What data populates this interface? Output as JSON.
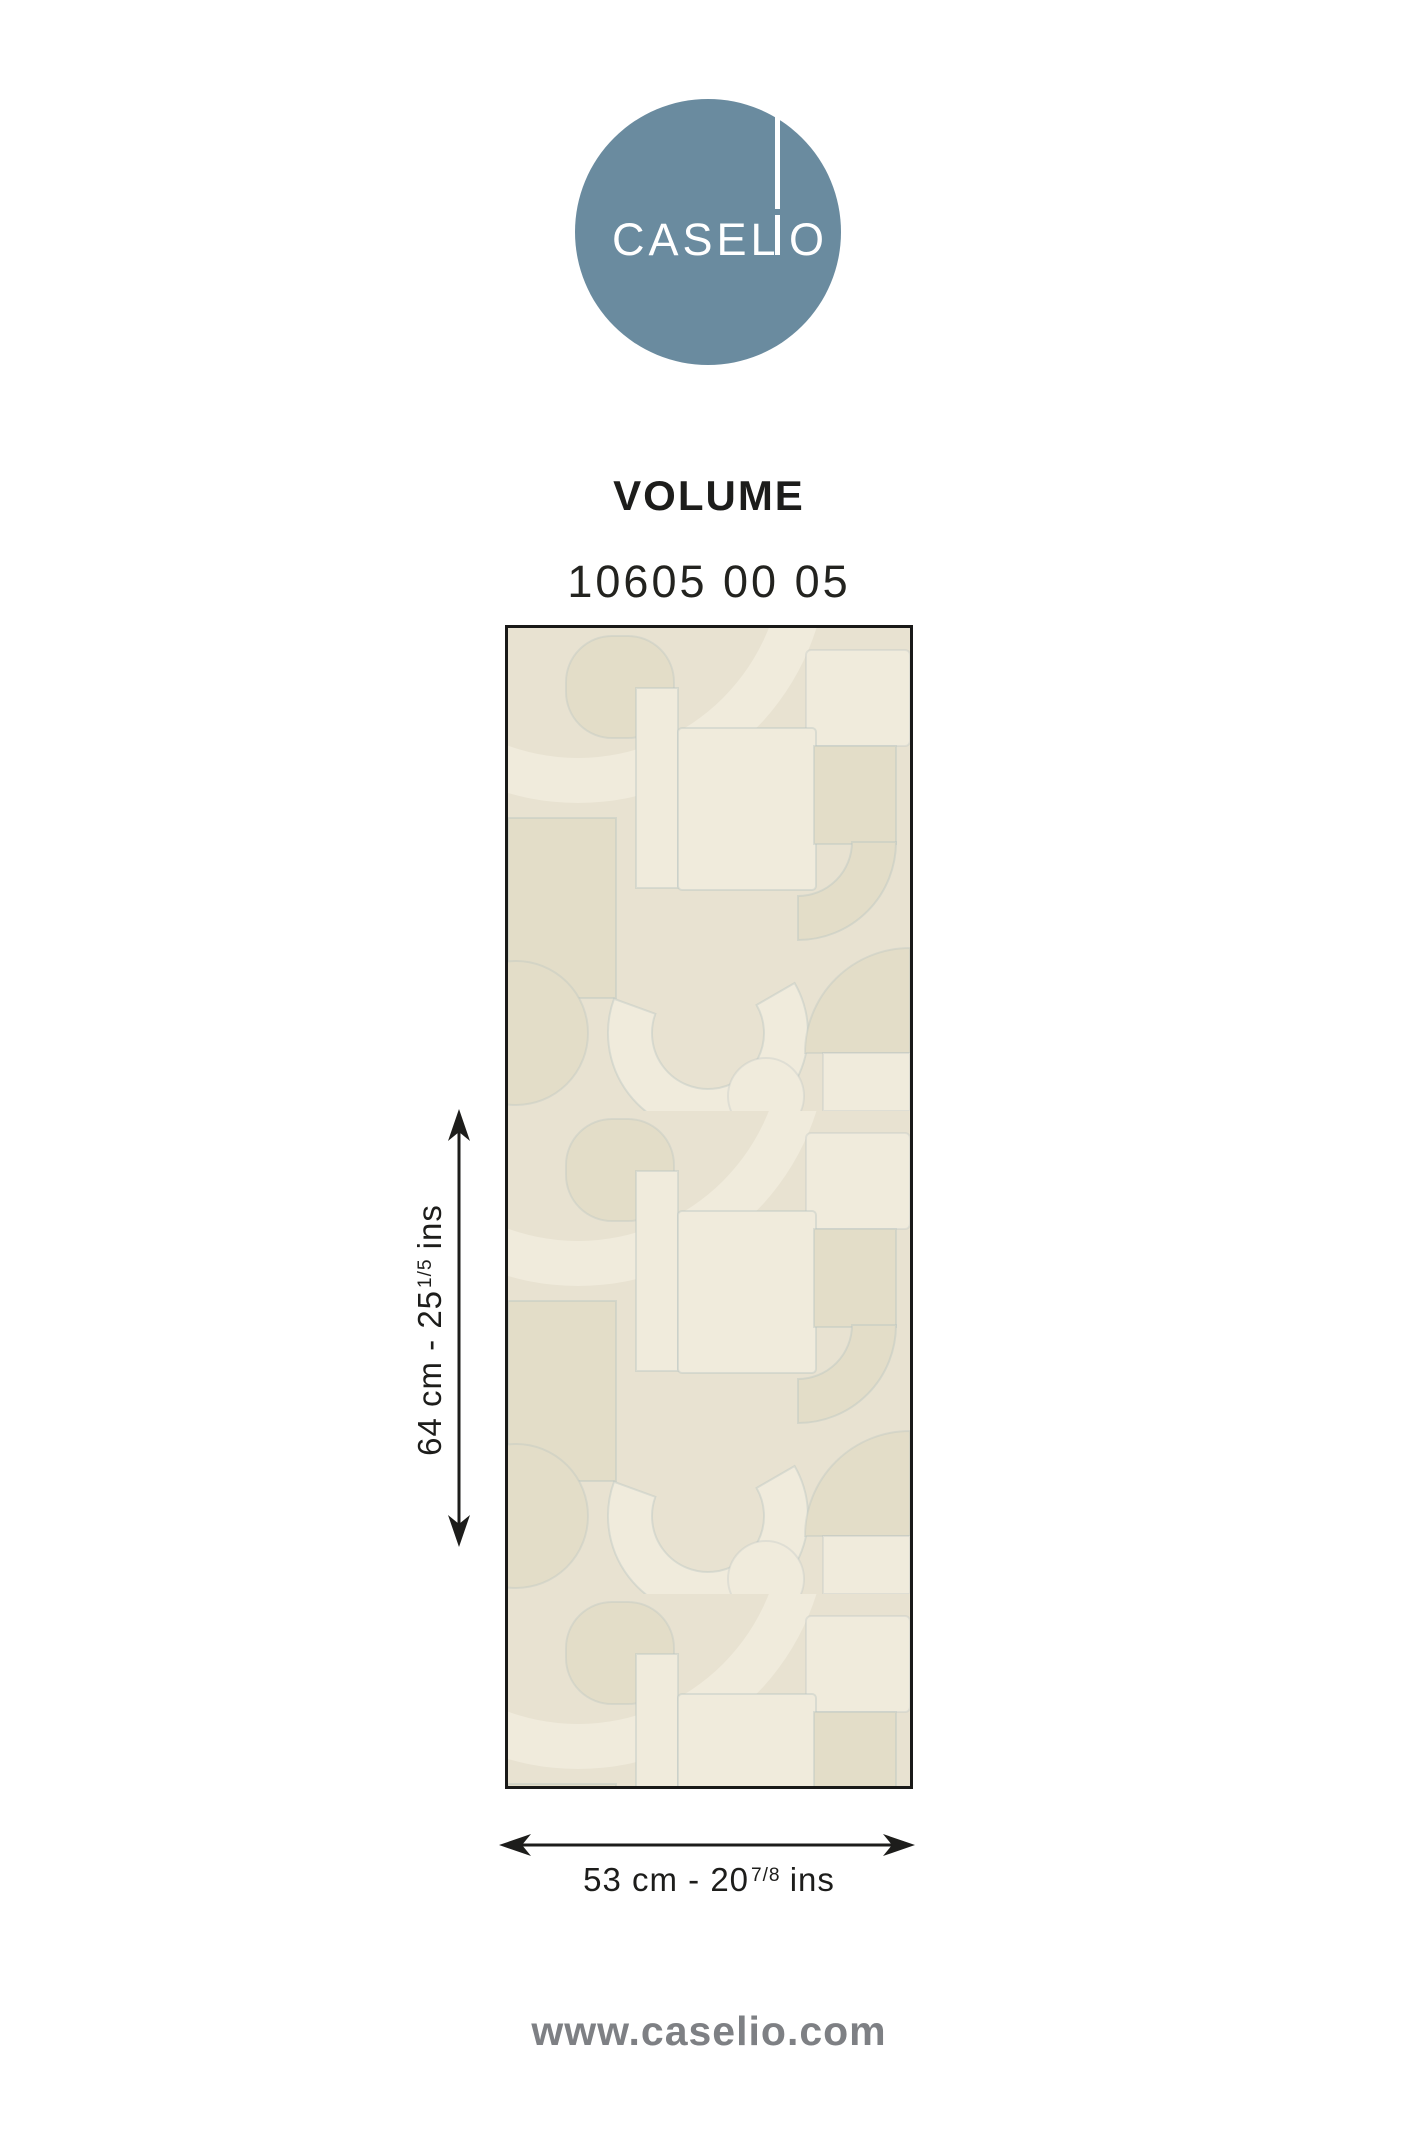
{
  "logo": {
    "brand": "CASELIO",
    "part_left": "CASEL",
    "part_right": "O",
    "circle_color": "#6A8B9F",
    "text_color": "#ffffff"
  },
  "product": {
    "collection": "VOLUME",
    "reference": "10605 00 05"
  },
  "swatch": {
    "border_color": "#191918",
    "colors": {
      "background": "#E8E2D1",
      "shape_dark": "#E3DDC8",
      "shape_light": "#F0EBDC",
      "edge_line": "#B7C2C0"
    }
  },
  "dimensions": {
    "height": {
      "prefix": "64 cm - 25",
      "fraction": "1/5",
      "suffix": "ins"
    },
    "width": {
      "prefix": "53 cm - 20",
      "fraction": "7/8",
      "suffix": "ins"
    }
  },
  "footer": {
    "website": "www.caselio.com"
  }
}
